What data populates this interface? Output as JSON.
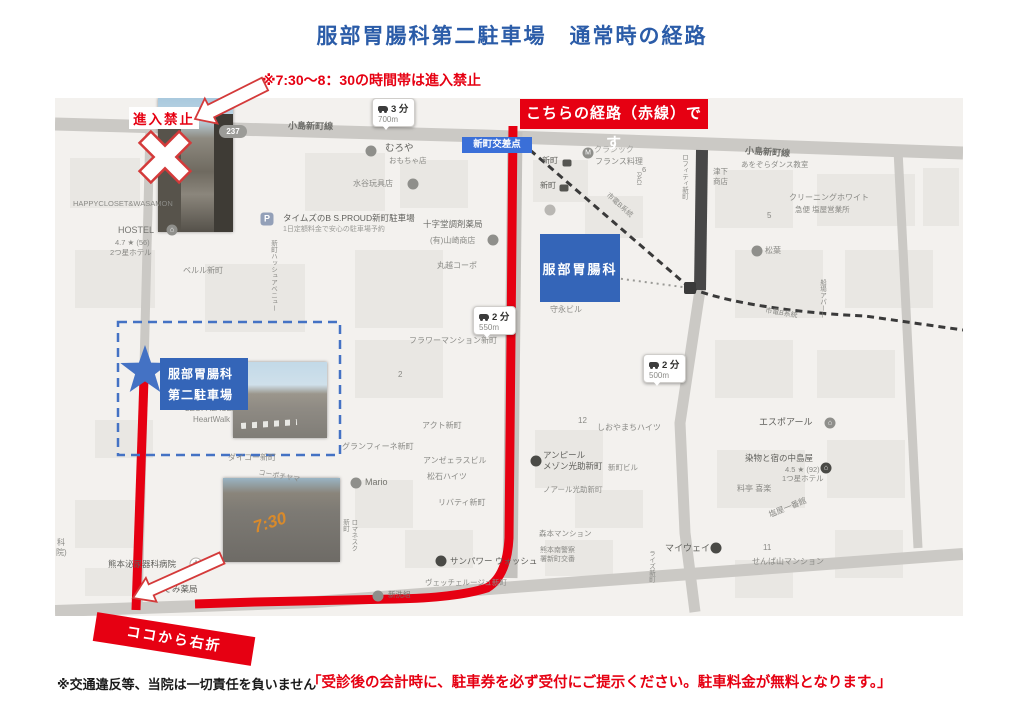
{
  "page": {
    "title": "服部胃腸科第二駐車場　通常時の経路",
    "time_restriction_note": "※7:30〜8：30の時間帯は進入禁止",
    "disclaimer": "※交通違反等、当院は一切責任を負いません",
    "parking_notice": "「受診後の会計時に、駐車券を必ず受付にご提示ください。駐車料金が無料となります。」"
  },
  "annotations": {
    "no_entry_label": "進入禁止",
    "route_banner": "こちらの経路（赤線）です",
    "turn_right_banner": "ココから右折",
    "photo_road_marking": "7:30"
  },
  "colors": {
    "title_blue": "#2b5ca8",
    "accent_red": "#e60012",
    "box_blue": "#3465b8",
    "badge_blue": "#3a6fd8",
    "dashed_blue": "#4472c4",
    "map_bg": "#f3f1ee",
    "tram_dark": "#3a3a3a"
  },
  "map": {
    "clinic_label": "服部胃腸科",
    "parking_label_line1": "服部胃腸科",
    "parking_label_line2": "第二駐車場",
    "intersection_badge": "新町交差点",
    "route_number": "237",
    "travel_badges": [
      {
        "x": 317,
        "y": 0,
        "time": "3 分",
        "dist": "700m"
      },
      {
        "x": 418,
        "y": 208,
        "time": "2 分",
        "dist": "550m"
      },
      {
        "x": 588,
        "y": 256,
        "time": "2 分",
        "dist": "500m"
      }
    ],
    "labels": [
      {
        "t": "小島新町線",
        "x": 233,
        "y": 23,
        "s": 9,
        "c": "#6e6e6a",
        "b": true,
        "r": 1
      },
      {
        "t": "小島新町線",
        "x": 690,
        "y": 49,
        "s": 9,
        "c": "#6e6e6a",
        "b": true,
        "r": 4
      },
      {
        "t": "HAPPYCLOSET&WASAMON",
        "x": 18,
        "y": 101,
        "s": 7.5
      },
      {
        "t": "HOSTEL",
        "x": 63,
        "y": 127,
        "s": 9,
        "c": "#757571"
      },
      {
        "t": "4.7 ★ (56)",
        "x": 60,
        "y": 140,
        "s": 7.5
      },
      {
        "t": "2つ星ホテル",
        "x": 55,
        "y": 150,
        "s": 7.5
      },
      {
        "t": "タイムズのB S.PROUD新町駐車場",
        "x": 228,
        "y": 115,
        "s": 8.5,
        "c": "#5f5f5b"
      },
      {
        "t": "1日定額料金で安心の駐車場予約",
        "x": 228,
        "y": 127,
        "s": 7,
        "c": "#9a9a96"
      },
      {
        "t": "むろや",
        "x": 330,
        "y": 45,
        "s": 9.5,
        "c": "#5f5f5b"
      },
      {
        "t": "おもちゃ店",
        "x": 334,
        "y": 58,
        "s": 7.5
      },
      {
        "t": "水谷玩具店",
        "x": 298,
        "y": 81,
        "s": 8
      },
      {
        "t": "十字堂調剤薬局",
        "x": 368,
        "y": 121,
        "s": 8.5,
        "c": "#6e6e6a"
      },
      {
        "t": "(有)山崎商店",
        "x": 375,
        "y": 138,
        "s": 8
      },
      {
        "t": "丸越コーポ",
        "x": 382,
        "y": 163,
        "s": 8
      },
      {
        "t": "ベルル新町",
        "x": 128,
        "y": 168,
        "s": 8
      },
      {
        "t": "新町ハッシュアベニュー",
        "x": 213,
        "y": 142,
        "s": 6.5,
        "v": true
      },
      {
        "t": "新町",
        "x": 487,
        "y": 58,
        "s": 8,
        "c": "#5f5f5b"
      },
      {
        "t": "新町",
        "x": 485,
        "y": 83,
        "s": 8,
        "c": "#5f5f5b"
      },
      {
        "t": "クラシック",
        "x": 539,
        "y": 47,
        "s": 8,
        "c": "#a5a5a1"
      },
      {
        "t": "フランス料理",
        "x": 540,
        "y": 59,
        "s": 8
      },
      {
        "t": "津下\n商店",
        "x": 658,
        "y": 69,
        "s": 7.5
      },
      {
        "t": "あをぞらダンス教室",
        "x": 686,
        "y": 62,
        "s": 7.5
      },
      {
        "t": "クリーニングホワイト",
        "x": 734,
        "y": 95,
        "s": 8
      },
      {
        "t": "急便 塩屋営業所",
        "x": 740,
        "y": 107,
        "s": 7.5
      },
      {
        "t": "5",
        "x": 712,
        "y": 113,
        "s": 8
      },
      {
        "t": "松葉",
        "x": 710,
        "y": 148,
        "s": 8
      },
      {
        "t": "6",
        "x": 587,
        "y": 67,
        "s": 7.5
      },
      {
        "t": "PACI",
        "x": 578,
        "y": 74,
        "s": 6,
        "v": true
      },
      {
        "t": "ロフィティ新町",
        "x": 624,
        "y": 56,
        "s": 6.5,
        "v": true
      },
      {
        "t": "市電B系統",
        "x": 548,
        "y": 103,
        "s": 7,
        "r": 42
      },
      {
        "t": "市電B系統",
        "x": 710,
        "y": 211,
        "s": 7,
        "r": 9
      },
      {
        "t": "船場アパート",
        "x": 762,
        "y": 181,
        "s": 6.5,
        "v": true
      },
      {
        "t": "守永ビル",
        "x": 495,
        "y": 207,
        "s": 8
      },
      {
        "t": "フラワーマンション新町",
        "x": 354,
        "y": 238,
        "s": 8
      },
      {
        "t": "2",
        "x": 343,
        "y": 272,
        "s": 8
      },
      {
        "t": "12",
        "x": 523,
        "y": 318,
        "s": 8
      },
      {
        "t": "しおやまちハイツ",
        "x": 542,
        "y": 325,
        "s": 8
      },
      {
        "t": "エスポアール",
        "x": 704,
        "y": 319,
        "s": 9,
        "c": "#5f5f5b"
      },
      {
        "t": "アクト新町",
        "x": 367,
        "y": 323,
        "s": 8
      },
      {
        "t": "グランフィーネ新町",
        "x": 287,
        "y": 344,
        "s": 8
      },
      {
        "t": "アンゼェラスビル",
        "x": 368,
        "y": 358,
        "s": 8
      },
      {
        "t": "松石ハイツ",
        "x": 372,
        "y": 374,
        "s": 8
      },
      {
        "t": "Mario",
        "x": 310,
        "y": 379,
        "s": 9,
        "c": "#75756f"
      },
      {
        "t": "リバティ新町",
        "x": 383,
        "y": 400,
        "s": 8
      },
      {
        "t": "アンピール\nメゾン光助新町",
        "x": 488,
        "y": 352,
        "s": 8.5,
        "c": "#5f5f5b"
      },
      {
        "t": "ノアール光助新町",
        "x": 488,
        "y": 387,
        "s": 7.5
      },
      {
        "t": "新町ビル",
        "x": 553,
        "y": 365,
        "s": 7.5
      },
      {
        "t": "染物と宿の中島屋",
        "x": 690,
        "y": 355,
        "s": 8.5,
        "c": "#5f5f5b"
      },
      {
        "t": "4.5 ★ (92)",
        "x": 730,
        "y": 367,
        "s": 7.5
      },
      {
        "t": "1つ星ホテル",
        "x": 727,
        "y": 376,
        "s": 7.5
      },
      {
        "t": "料亭 喜楽",
        "x": 682,
        "y": 386,
        "s": 8
      },
      {
        "t": "塩屋一番館",
        "x": 713,
        "y": 405,
        "s": 8,
        "r": -22
      },
      {
        "t": "11",
        "x": 708,
        "y": 445,
        "s": 8
      },
      {
        "t": "せんば山マンション",
        "x": 697,
        "y": 459,
        "s": 8
      },
      {
        "t": "マイウェイ",
        "x": 610,
        "y": 445,
        "s": 9,
        "c": "#5f5f5b"
      },
      {
        "t": "ライズ新町",
        "x": 591,
        "y": 452,
        "s": 6.5,
        "v": true
      },
      {
        "t": "森本マンション",
        "x": 484,
        "y": 431,
        "s": 7.5
      },
      {
        "t": "熊本南警察\n署新町交番",
        "x": 485,
        "y": 448,
        "s": 7
      },
      {
        "t": "サンパワー ウォッシュ",
        "x": 395,
        "y": 458,
        "s": 8.5,
        "c": "#5f5f5b"
      },
      {
        "t": "ヴェッチェルージュ新町",
        "x": 370,
        "y": 480,
        "s": 7.5
      },
      {
        "t": "新洗組",
        "x": 333,
        "y": 492,
        "s": 7.5,
        "c": "#75756f"
      },
      {
        "t": "熊本泌尿器科病院",
        "x": 53,
        "y": 461,
        "s": 8.5,
        "c": "#5f5f5b"
      },
      {
        "t": "のぞみ薬局",
        "x": 100,
        "y": 486,
        "s": 8.5,
        "c": "#5f5f5b"
      },
      {
        "t": "ダイコー新町",
        "x": 173,
        "y": 355,
        "s": 8
      },
      {
        "t": "コーポチヤマ",
        "x": 203,
        "y": 374,
        "s": 7,
        "r": 10
      },
      {
        "t": "ロマネスク\n新町",
        "x": 285,
        "y": 421,
        "s": 6.5,
        "v": true
      },
      {
        "t": "LEOPALACE2",
        "x": 130,
        "y": 306,
        "s": 8
      },
      {
        "t": "HeartWalk",
        "x": 138,
        "y": 317,
        "s": 8
      },
      {
        "t": "科",
        "x": 2,
        "y": 440,
        "s": 8
      },
      {
        "t": "院)",
        "x": 1,
        "y": 450,
        "s": 8
      }
    ],
    "icons": [
      {
        "x": 117,
        "y": 132,
        "g": "⌂",
        "n": "hostel-icon"
      },
      {
        "x": 212,
        "y": 121,
        "g": "P",
        "bg": "#93a0b8",
        "shape": "rsq",
        "n": "parking-icon"
      },
      {
        "x": 316,
        "y": 53,
        "g": "",
        "n": "shop-icon"
      },
      {
        "x": 358,
        "y": 86,
        "g": "",
        "n": "toy-shop-icon"
      },
      {
        "x": 495,
        "y": 112,
        "g": "",
        "bg": "#b9b7b3",
        "n": "pharmacy-icon"
      },
      {
        "x": 438,
        "y": 142,
        "g": "",
        "n": "shop-icon"
      },
      {
        "x": 533,
        "y": 55,
        "g": "M",
        "n": "restaurant-icon"
      },
      {
        "x": 512,
        "y": 65,
        "shape": "sq",
        "g": "",
        "n": "tram-stop-icon"
      },
      {
        "x": 509,
        "y": 90,
        "shape": "sq",
        "g": "",
        "n": "tram-stop-icon"
      },
      {
        "x": 702,
        "y": 153,
        "g": "",
        "n": "restaurant-icon"
      },
      {
        "x": 775,
        "y": 325,
        "g": "⌂",
        "n": "hotel-icon"
      },
      {
        "x": 771,
        "y": 370,
        "g": "⌂",
        "bg": "#4a4a46",
        "n": "hotel-icon"
      },
      {
        "x": 661,
        "y": 450,
        "g": "",
        "bg": "#4a4a46",
        "n": "bar-icon"
      },
      {
        "x": 481,
        "y": 363,
        "g": "",
        "bg": "#4a4a46",
        "n": "apartment-icon"
      },
      {
        "x": 386,
        "y": 463,
        "g": "",
        "bg": "#4a4a46",
        "n": "laundry-icon"
      },
      {
        "x": 323,
        "y": 498,
        "g": "",
        "n": "laundry-icon"
      },
      {
        "x": 141,
        "y": 466,
        "g": "✚",
        "bg": "#ffffff",
        "fg": "#8a8a86",
        "bd": true,
        "n": "hospital-icon"
      },
      {
        "x": 91,
        "y": 490,
        "g": "★",
        "bg": "#4a4a46",
        "n": "pharmacy-icon"
      },
      {
        "x": 301,
        "y": 385,
        "g": "",
        "n": "cafe-icon"
      }
    ]
  }
}
